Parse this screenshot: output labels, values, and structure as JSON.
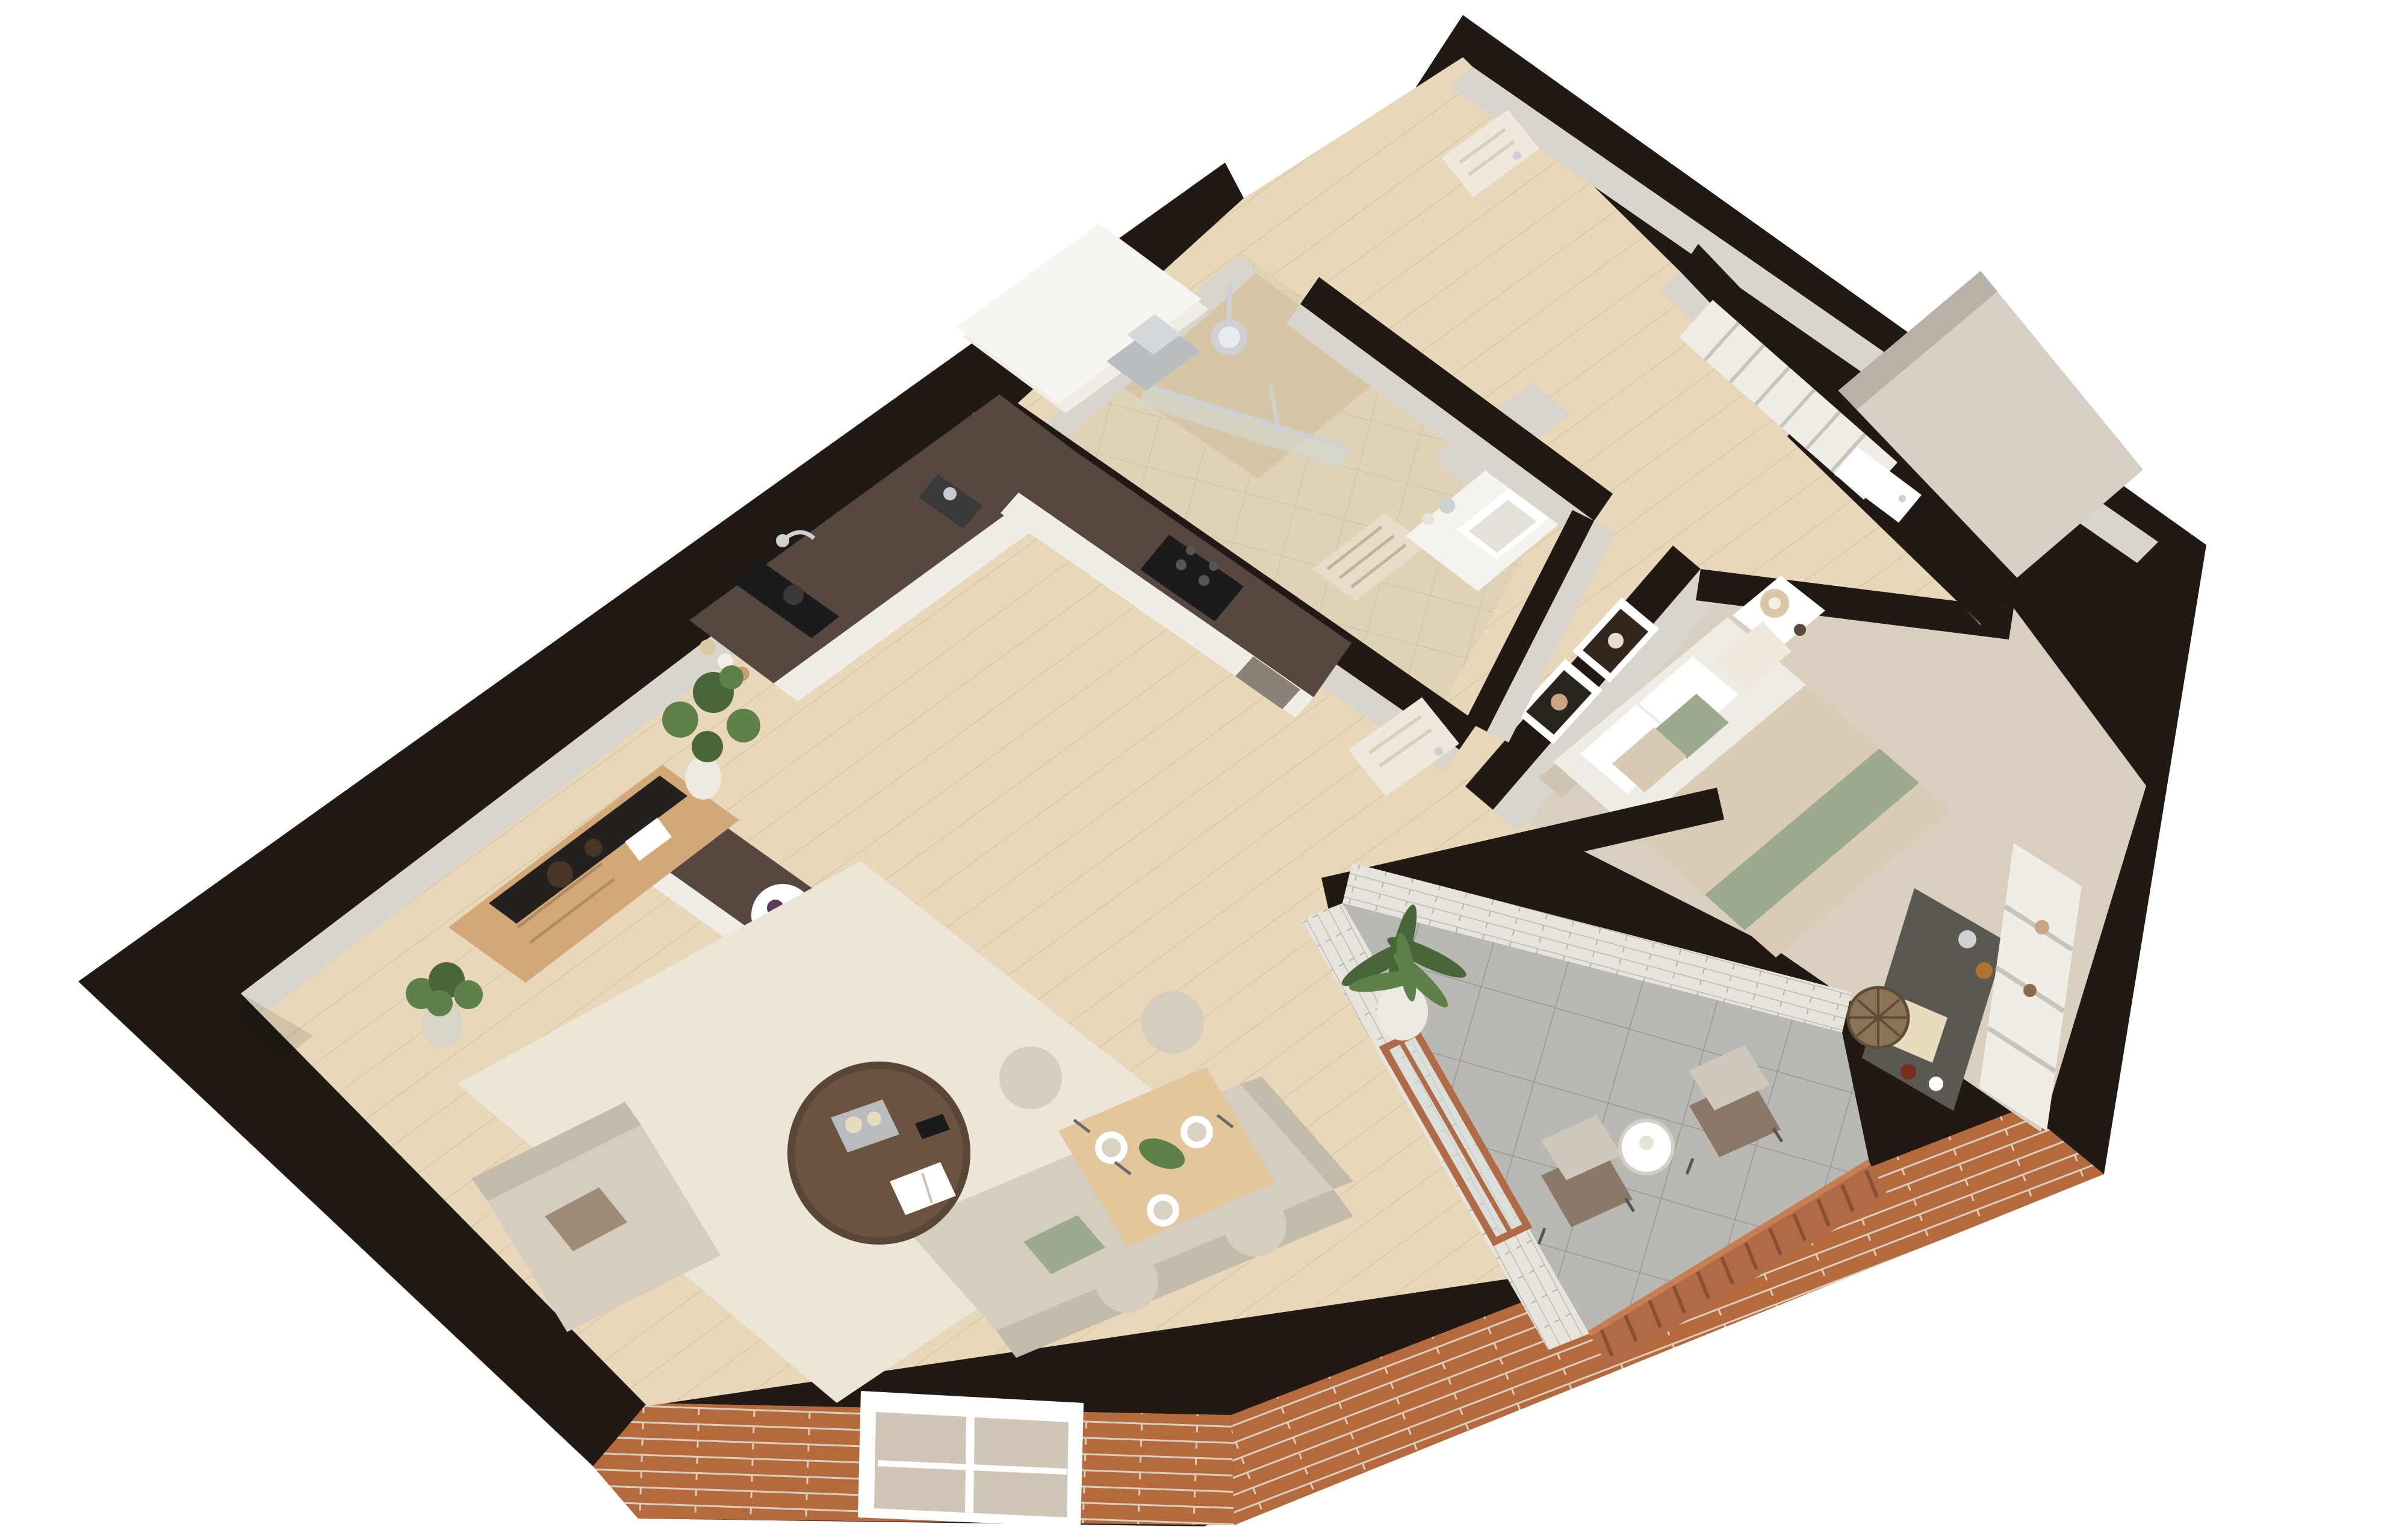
{
  "meta": {
    "type": "3d-floor-plan",
    "view": "isometric-cutaway-top-down",
    "subject": "one-bedroom apartment render",
    "background": "#ffffff",
    "visible_text": ""
  },
  "colors": {
    "wall": "#211a14",
    "wallFace": "#d9d5cc",
    "wallFaceShade": "#b7b1a7",
    "wood": "#e9d7ba",
    "woodLine": "#c8a677",
    "rug": "#ece6d9",
    "bathFloor": "#e0d2b6",
    "bathShower": "#d7c6a6",
    "carpet": "#d8cfc0",
    "balconyTile": "#bab8b3",
    "balconyLine": "#999691",
    "whiteBrick": "#e6e4dc",
    "whiteBrickLine": "#b5b3a9",
    "brick": "#b56a3e",
    "brickLine": "#d9cfbf",
    "terracotta": "#b06a45",
    "marble": "#564741",
    "cabinet": "#f0ede7",
    "sofa": "#d5cec0",
    "sofaShade": "#c3bcac",
    "green": "#9cab8e",
    "plant": "#5e8049",
    "plantDark": "#47663a",
    "woodFurn": "#d2a976",
    "woodFurnLight": "#e3c69c",
    "tableDark": "#5a4637",
    "glass": "#cfdad8",
    "chrome": "#cdd1d4",
    "appliance": "#1b1b1b",
    "door": "#efe9dd",
    "bedDuvet": "#d9cbb4",
    "mattress": "#efece5",
    "lamp": "#d9c8a8",
    "stool": "#8a7357",
    "deskTop": "#5b5751"
  },
  "apartment": {
    "rooms": [
      {
        "id": "living-room",
        "floor": "light-wood-plank",
        "furniture": [
          "three-seat-sofa",
          "armchair",
          "round-dark-coffee-table",
          "area-rug",
          "tv-sideboard",
          "tv-panel",
          "floor-plant",
          "tall-plant",
          "book",
          "candle-tray",
          "remote-control"
        ]
      },
      {
        "id": "dining-area",
        "floor": "light-wood-plank",
        "furniture": [
          "wood-dining-table",
          "upholstered-chairs",
          "place-settings",
          "centerpiece-plant"
        ]
      },
      {
        "id": "kitchen",
        "floor": "light-wood-plank",
        "furniture": [
          "l-shaped-counter",
          "dark-marble-countertop",
          "black-double-sink",
          "chrome-faucet",
          "induction-hob",
          "oven",
          "fridge-tall-units",
          "stainless-extractor-hood",
          "coffee-machine",
          "spice-jars",
          "peninsula-island",
          "fruit-plate"
        ]
      },
      {
        "id": "bathroom",
        "floor": "beige-tile",
        "furniture": [
          "walk-in-shower",
          "glass-screen",
          "rain-shower-head",
          "hand-shower",
          "vanity-counter",
          "white-basin",
          "mirror-cabinet",
          "bath-mat",
          "small-plant"
        ]
      },
      {
        "id": "hallway",
        "floor": "light-wood-plank",
        "furniture": [
          "entry-door",
          "built-in-wardrobe",
          "bathroom-door",
          "bedroom-door"
        ]
      },
      {
        "id": "closet-room",
        "floor": "greige",
        "furniture": [
          "white-door"
        ]
      },
      {
        "id": "bedroom",
        "floor": "beige-carpet",
        "furniture": [
          "double-bed",
          "beige-duvet",
          "sage-green-throw",
          "pillows",
          "headboard",
          "nightstand",
          "table-lamp",
          "two-abstract-art-frames",
          "dark-top-desk",
          "rattan-stool",
          "white-shelving-unit"
        ]
      },
      {
        "id": "balcony",
        "floor": "gray-tile",
        "furniture": [
          "potted-palm",
          "two-lounge-chairs",
          "round-side-table",
          "terracotta-railing",
          "glazed-white-brick-walls",
          "terracotta-frame-glass-door"
        ]
      }
    ],
    "exterior": {
      "facade": "orange-brick-with-mortar-joints",
      "window": "white-frame-window-in-brick",
      "railing_bar_count": 24
    }
  }
}
